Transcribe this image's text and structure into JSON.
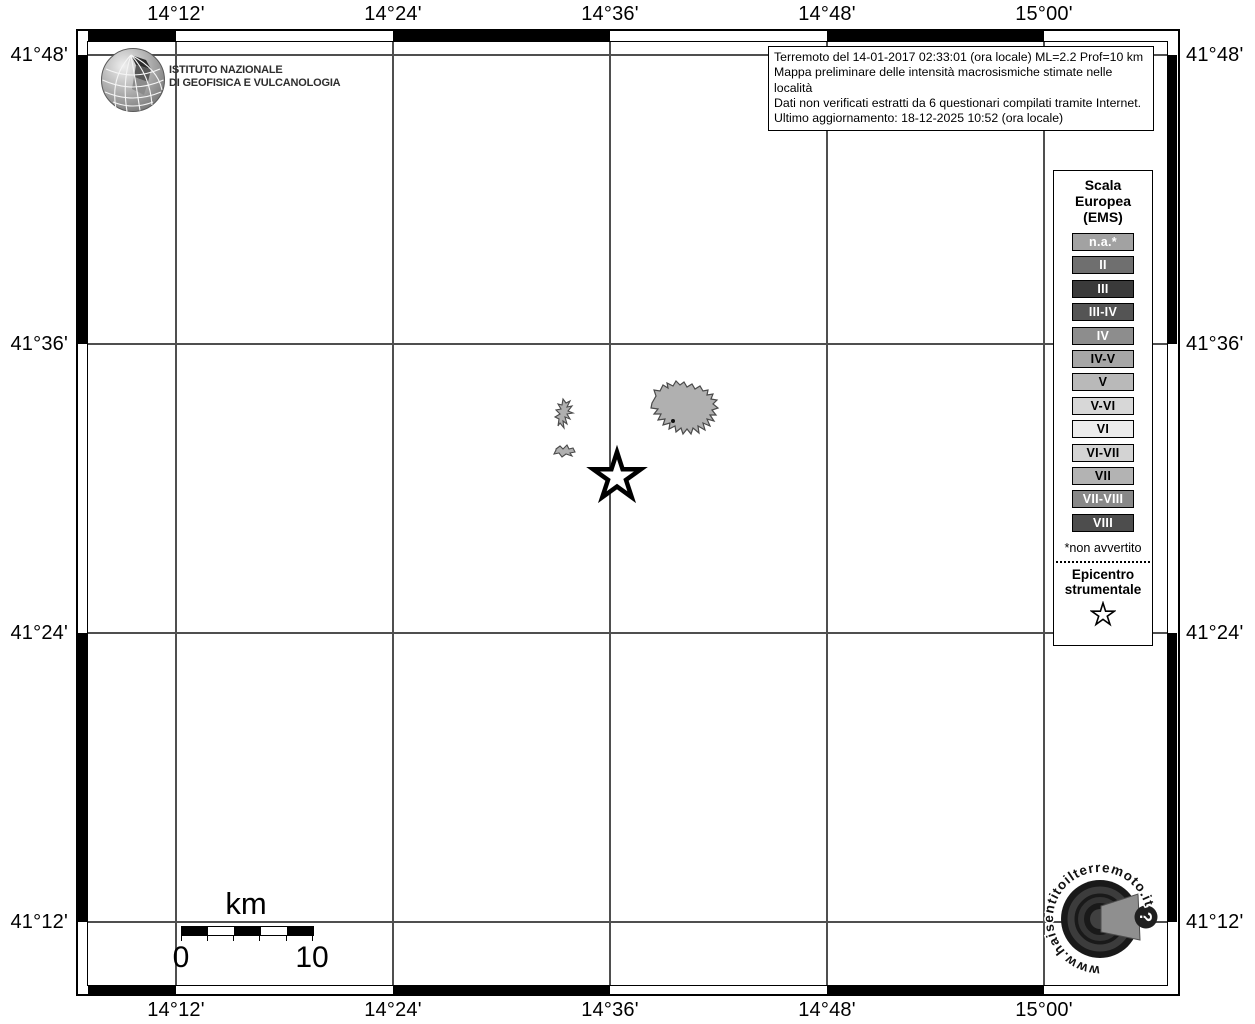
{
  "info_box": {
    "lines": [
      "Terremoto del 14-01-2017 02:33:01 (ora locale) ML=2.2 Prof=10 km",
      "Mappa preliminare delle intensità macrosismiche stimate nelle località",
      "Dati non verificati estratti da 6 questionari compilati tramite Internet.",
      "Ultimo aggiornamento: 18-12-2025 10:52 (ora locale)"
    ]
  },
  "axes": {
    "top": [
      "14°12'",
      "14°24'",
      "14°36'",
      "14°48'",
      "15°00'"
    ],
    "bottom": [
      "14°12'",
      "14°24'",
      "14°36'",
      "14°48'",
      "15°00'"
    ],
    "left": [
      "41°48'",
      "41°36'",
      "41°24'",
      "41°12'"
    ],
    "right": [
      "41°48'",
      "41°36'",
      "41°24'",
      "41°12'"
    ]
  },
  "legend": {
    "title_lines": [
      "Scala",
      "Europea",
      "(EMS)"
    ],
    "items": [
      {
        "label": "n.a.*",
        "bg": "#a2a2a2",
        "fg": "#ffffff"
      },
      {
        "label": "II",
        "bg": "#6f6f6f",
        "fg": "#ffffff"
      },
      {
        "label": "III",
        "bg": "#3a3a3a",
        "fg": "#ffffff"
      },
      {
        "label": "III-IV",
        "bg": "#545454",
        "fg": "#ffffff"
      },
      {
        "label": "IV",
        "bg": "#8d8d8d",
        "fg": "#ffffff"
      },
      {
        "label": "IV-V",
        "bg": "#a6a6a6",
        "fg": "#000000"
      },
      {
        "label": "V",
        "bg": "#b9b9b9",
        "fg": "#000000"
      },
      {
        "label": "V-VI",
        "bg": "#d7d7d7",
        "fg": "#000000"
      },
      {
        "label": "VI",
        "bg": "#ececec",
        "fg": "#000000"
      },
      {
        "label": "VI-VII",
        "bg": "#d3d3d3",
        "fg": "#000000"
      },
      {
        "label": "VII",
        "bg": "#b3b3b3",
        "fg": "#000000"
      },
      {
        "label": "VII-VIII",
        "bg": "#888888",
        "fg": "#ffffff"
      },
      {
        "label": "VIII",
        "bg": "#4d4d4d",
        "fg": "#ffffff"
      }
    ],
    "footnote": "*non avvertito",
    "epicenter_label_lines": [
      "Epicentro",
      "strumentale"
    ]
  },
  "scale_bar": {
    "unit": "km",
    "start_label": "0",
    "end_label": "10"
  },
  "ingv_logo": {
    "name_line1": "ISTITUTO NAZIONALE",
    "name_line2": "DI GEOFISICA E VULCANOLOGIA"
  },
  "hsit_logo": {
    "circular_text": "www.haisentitoilterremoto.it",
    "badge": "?"
  },
  "map_features": {
    "epicenter_symbol": "star",
    "locality_fill": "#b0b0b0",
    "locality_stroke": "#4a4a4a",
    "grid_color": "#4f4f4f"
  }
}
